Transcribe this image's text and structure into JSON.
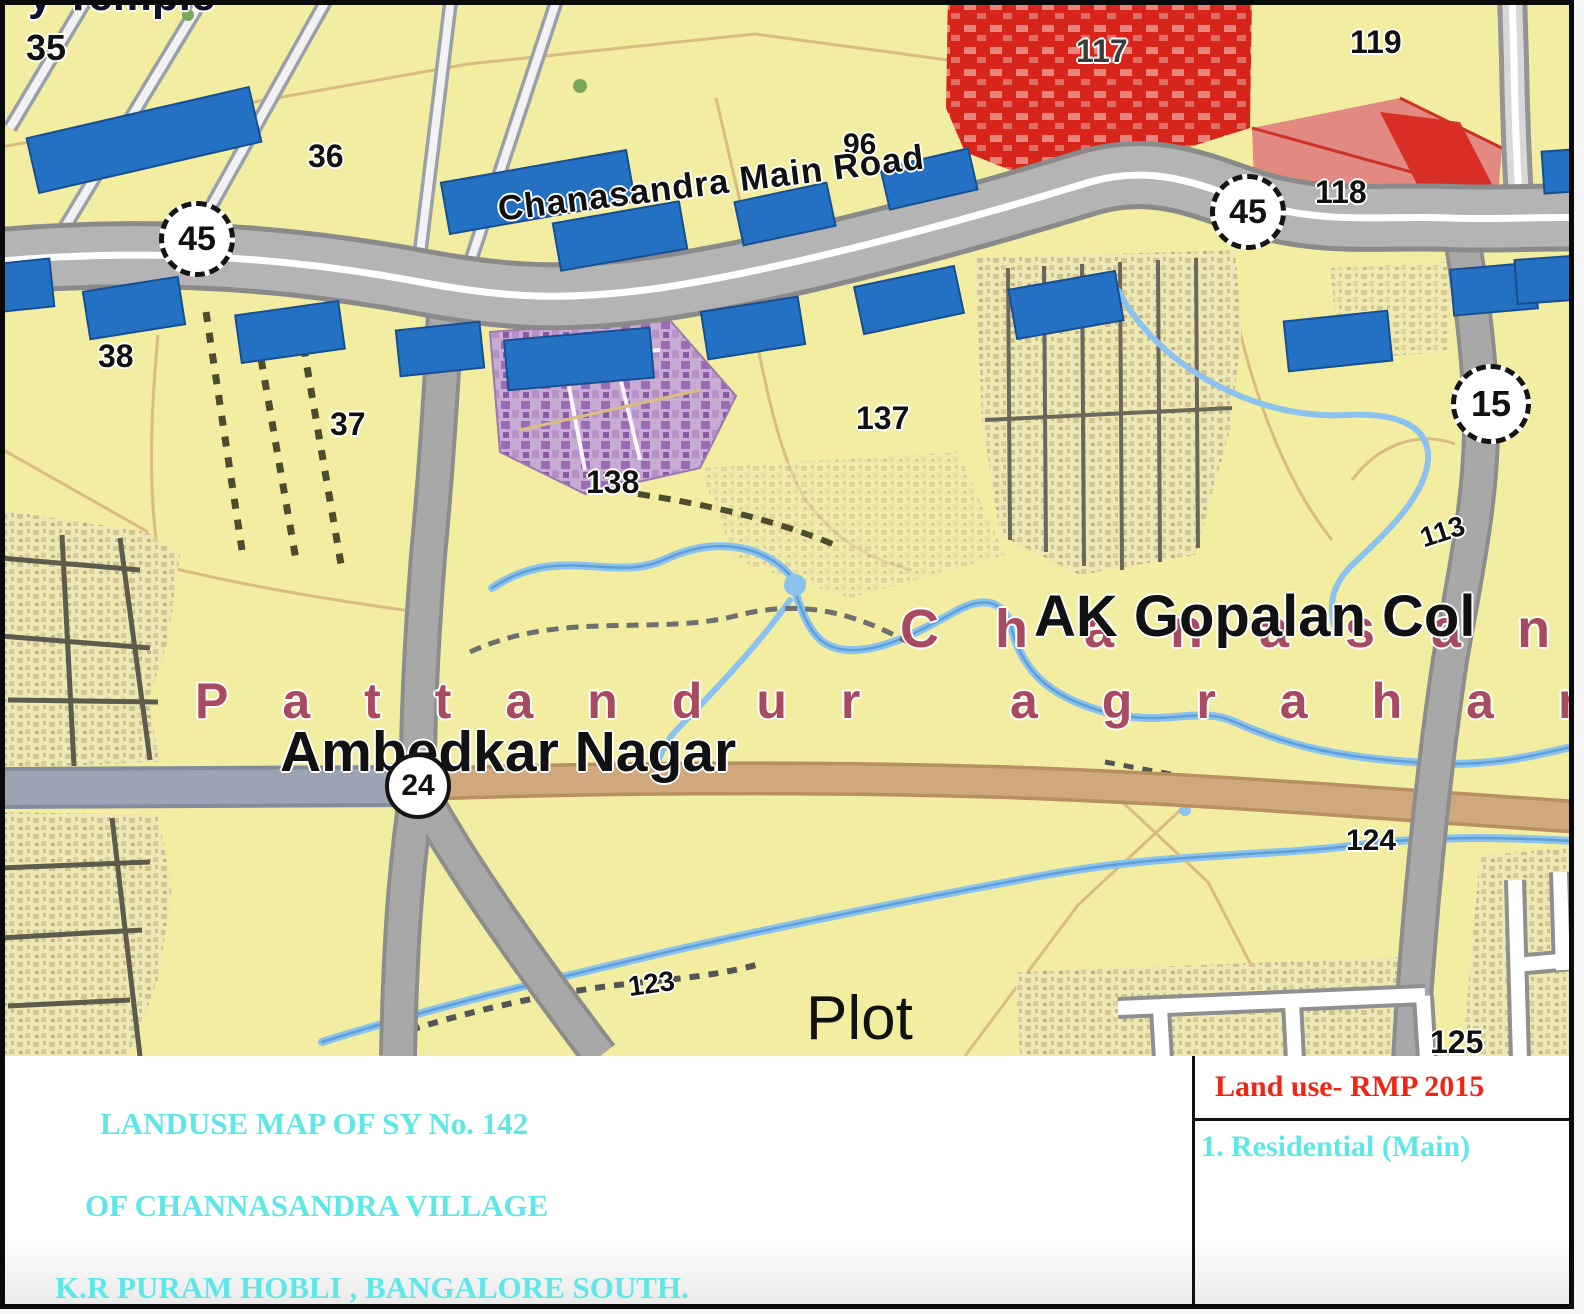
{
  "map": {
    "road_label": "Chanasandra Main Road",
    "badges": {
      "b45_left": "45",
      "b45_right": "45",
      "b15": "15",
      "b24": "24"
    },
    "survey": {
      "n35": "35",
      "n36": "36",
      "n37": "37",
      "n38": "38",
      "n96": "96",
      "n113": "113",
      "n117": "117",
      "n118": "118",
      "n119": "119",
      "n123": "123",
      "n124": "124",
      "n125": "125",
      "n137": "137",
      "n138": "138"
    },
    "places": {
      "pattandur": "Pattandur",
      "agrahar": "agrahar",
      "chanasandra_spaced": "Chanasandra",
      "ambedkar_nagar": "Ambedkar Nagar",
      "ak_gopalan_col": "AK Gopalan Col",
      "plot": "Plot",
      "temple_clipped": "y Temple"
    }
  },
  "title_block": {
    "line1": "LANDUSE MAP OF SY No. 142",
    "line2": "OF CHANNASANDRA VILLAGE",
    "line3": "K.R PURAM HOBLI , BANGALORE SOUTH."
  },
  "legend": {
    "header": "Land use- RMP 2015",
    "item1": "1. Residential (Main)"
  },
  "colors": {
    "residential_yellow": "#f3eda1",
    "commercial_red": "#d8251c",
    "mixed_pink": "#e28981",
    "existing_purple": "#c6abd4",
    "tdr_blue_dash": "#2470c2",
    "road_gray": "#b4b4b4",
    "tan_road": "#cfa87e",
    "stream_blue": "#8cc2ee",
    "village_khaki": "#eee8b4",
    "place_maroon": "#a84a60",
    "title_cyan": "#5fe7e7",
    "legend_red": "#ee2615"
  }
}
